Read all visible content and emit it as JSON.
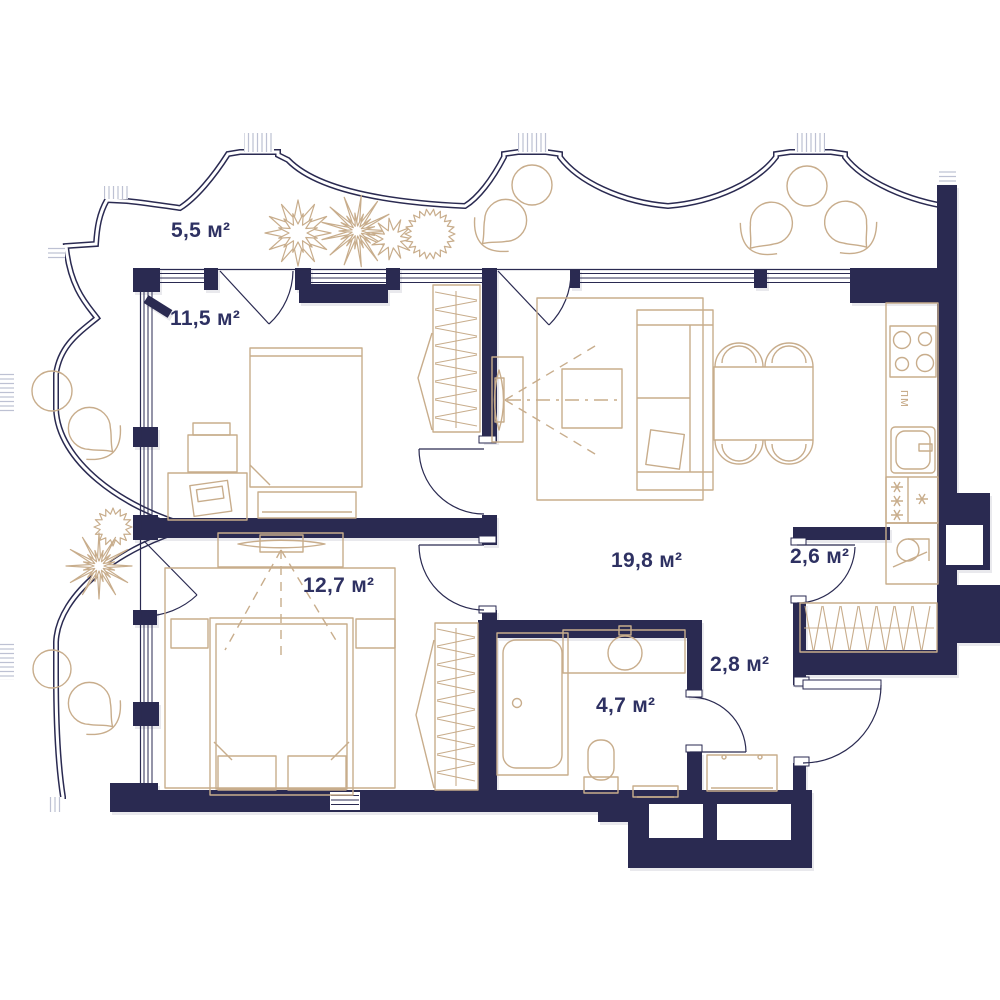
{
  "floor_plan": {
    "rooms": [
      {
        "name": "balcony",
        "area": "5,5 м²"
      },
      {
        "name": "bedroom-small",
        "area": "11,5 м²"
      },
      {
        "name": "bedroom-large",
        "area": "12,7 м²"
      },
      {
        "name": "living-kitchen",
        "area": "19,8 м²"
      },
      {
        "name": "storage",
        "area": "2,6 м²"
      },
      {
        "name": "hallway",
        "area": "2,8 м²"
      },
      {
        "name": "bathroom",
        "area": "4,7 м²"
      }
    ],
    "annotations": {
      "dishwasher": "пм"
    },
    "colors": {
      "walls": "#2a2a51",
      "furniture": "#c8ad8c",
      "labels": "#2e3162",
      "background": "#ffffff"
    }
  }
}
